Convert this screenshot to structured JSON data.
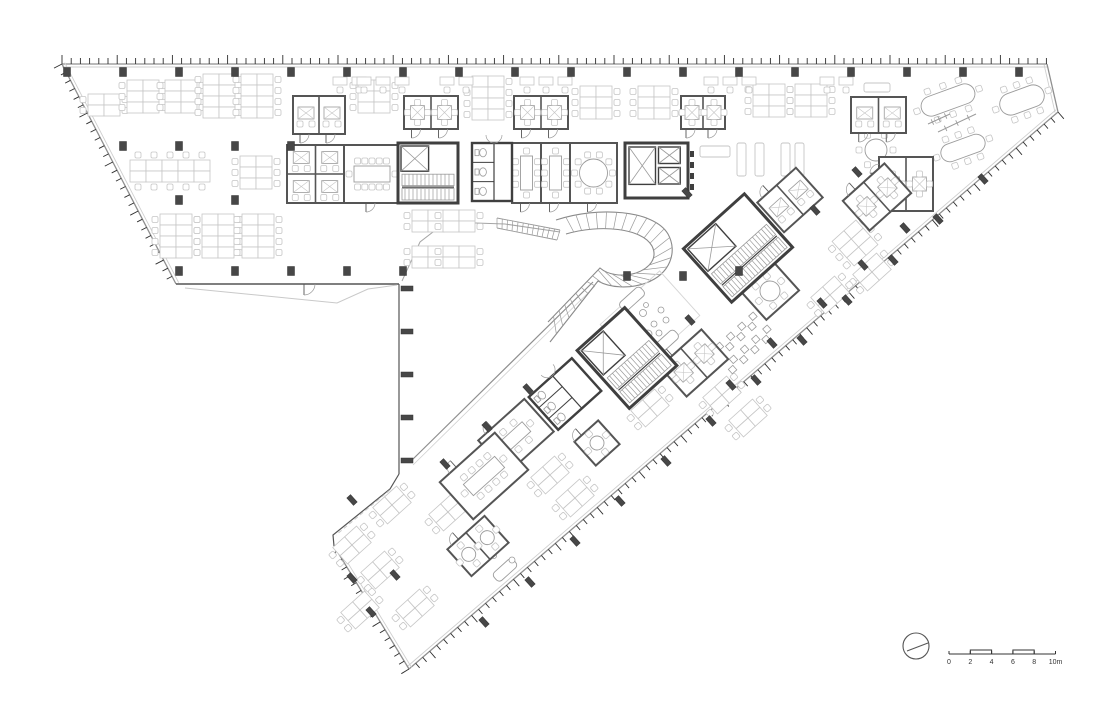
{
  "canvas": {
    "w": 1100,
    "h": 702,
    "bg": "#ffffff"
  },
  "colors": {
    "facade": "#8f8f8f",
    "facadeInner": "#cfcfcf",
    "tick": "#2e2e2e",
    "wall": "#555555",
    "wallDark": "#3f3f3f",
    "furn": "#c6c6c6",
    "furnMid": "#9b9b9b",
    "column": "#474747",
    "canopy": "#c9c9c9",
    "tread": "#9a9a9a",
    "curve": "#a5a5a5",
    "text": "#333333"
  },
  "facades": [
    {
      "x1": 62,
      "y1": 64,
      "x2": 1047,
      "y2": 64,
      "ticks": true,
      "side": -1
    },
    {
      "x1": 62,
      "y1": 64,
      "x2": 176,
      "y2": 284,
      "ticks": true,
      "side": 1
    },
    {
      "x1": 1047,
      "y1": 64,
      "x2": 1058,
      "y2": 112,
      "ticks": false,
      "side": -1
    },
    {
      "x1": 1058,
      "y1": 112,
      "x2": 409,
      "y2": 669,
      "ticks": true,
      "side": -1
    },
    {
      "x1": 409,
      "y1": 669,
      "x2": 334,
      "y2": 546,
      "ticks": true,
      "side": -1
    }
  ],
  "edges": [
    {
      "pts": [
        [
          334,
          546
        ],
        [
          333,
          535
        ],
        [
          390,
          489
        ],
        [
          399,
          474
        ]
      ],
      "w": 1.2,
      "c": "wall"
    },
    {
      "pts": [
        [
          399,
          474
        ],
        [
          399,
          284
        ]
      ],
      "w": 1.2,
      "c": "wall"
    },
    {
      "pts": [
        [
          399,
          284
        ],
        [
          176,
          284
        ]
      ],
      "w": 1.6,
      "c": "wall"
    },
    {
      "pts": [
        [
          185,
          288
        ],
        [
          337,
          303
        ],
        [
          368,
          289
        ],
        [
          397,
          285
        ]
      ],
      "w": 1,
      "c": "canopy"
    },
    {
      "pts": [
        [
          402,
          281
        ],
        [
          420,
          242
        ],
        [
          446,
          222
        ],
        [
          505,
          224
        ],
        [
          560,
          232
        ]
      ],
      "w": 1,
      "c": "curve"
    },
    {
      "pts": [
        [
          593,
          282
        ],
        [
          410,
          462
        ]
      ],
      "w": 1.2,
      "c": "facade"
    },
    {
      "pts": [
        [
          595,
          286
        ],
        [
          413,
          465
        ]
      ],
      "w": 0.8,
      "c": "facadeInner"
    },
    {
      "pts": [
        [
          390,
          490
        ],
        [
          336,
          535
        ]
      ],
      "w": 1,
      "c": "canopy",
      "dash": "4 3"
    }
  ],
  "entranceDoor": {
    "hx": 304,
    "hy": 284,
    "r": 11
  },
  "piers": {
    "vertical": [
      [
        401,
        286
      ],
      [
        401,
        329
      ],
      [
        401,
        372
      ],
      [
        401,
        415
      ],
      [
        401,
        458
      ]
    ],
    "rotated": [
      [
        687,
        193
      ],
      [
        815,
        210
      ],
      [
        857,
        172
      ],
      [
        905,
        228
      ],
      [
        863,
        265
      ],
      [
        822,
        303
      ],
      [
        690,
        320
      ],
      [
        772,
        343
      ],
      [
        731,
        385
      ],
      [
        528,
        389
      ],
      [
        487,
        427
      ],
      [
        445,
        464
      ],
      [
        352,
        500
      ],
      [
        395,
        575
      ]
    ],
    "facade": [
      [
        983,
        179
      ],
      [
        938,
        219
      ],
      [
        893,
        260
      ],
      [
        847,
        300
      ],
      [
        802,
        340
      ],
      [
        756,
        380
      ],
      [
        711,
        421
      ],
      [
        666,
        461
      ],
      [
        620,
        501
      ],
      [
        575,
        541
      ],
      [
        530,
        582
      ],
      [
        484,
        622
      ],
      [
        371,
        612
      ],
      [
        352,
        578
      ]
    ]
  },
  "columns": [
    [
      67,
      72
    ],
    [
      123,
      72
    ],
    [
      179,
      72
    ],
    [
      235,
      72
    ],
    [
      291,
      72
    ],
    [
      347,
      72
    ],
    [
      403,
      72
    ],
    [
      459,
      72
    ],
    [
      515,
      72
    ],
    [
      571,
      72
    ],
    [
      627,
      72
    ],
    [
      683,
      72
    ],
    [
      739,
      72
    ],
    [
      795,
      72
    ],
    [
      851,
      72
    ],
    [
      907,
      72
    ],
    [
      963,
      72
    ],
    [
      1019,
      72
    ],
    [
      123,
      146
    ],
    [
      179,
      146
    ],
    [
      235,
      146
    ],
    [
      291,
      146
    ],
    [
      179,
      200
    ],
    [
      235,
      200
    ],
    [
      179,
      271
    ],
    [
      235,
      271
    ],
    [
      291,
      271
    ],
    [
      347,
      271
    ],
    [
      403,
      271
    ],
    [
      627,
      276
    ],
    [
      683,
      276
    ],
    [
      739,
      271
    ]
  ],
  "clusters": {
    "axis": [
      [
        88,
        94,
        2,
        2
      ],
      [
        127,
        80,
        2,
        3
      ],
      [
        165,
        80,
        2,
        3
      ],
      [
        203,
        74,
        2,
        4
      ],
      [
        241,
        74,
        2,
        4
      ],
      [
        240,
        156,
        2,
        3
      ],
      [
        160,
        214,
        2,
        4
      ],
      [
        202,
        214,
        2,
        4
      ],
      [
        242,
        214,
        2,
        4
      ],
      [
        358,
        80,
        2,
        3
      ],
      [
        472,
        76,
        2,
        4
      ],
      [
        580,
        86,
        2,
        3
      ],
      [
        638,
        86,
        2,
        3
      ],
      [
        412,
        210,
        2,
        2
      ],
      [
        443,
        210,
        2,
        2
      ],
      [
        412,
        246,
        2,
        2
      ],
      [
        443,
        246,
        2,
        2
      ],
      [
        753,
        84,
        2,
        3
      ],
      [
        795,
        84,
        2,
        3
      ]
    ],
    "bench": [
      [
        130,
        160,
        5,
        2
      ]
    ],
    "rot": [
      [
        855,
        243,
        2,
        3
      ],
      [
        872,
        272,
        2,
        2
      ],
      [
        830,
        295,
        2,
        2
      ],
      [
        722,
        395,
        2,
        2
      ],
      [
        748,
        418,
        2,
        2
      ],
      [
        650,
        408,
        2,
        2
      ],
      [
        550,
        475,
        2,
        2
      ],
      [
        575,
        498,
        2,
        2
      ],
      [
        392,
        505,
        2,
        2
      ],
      [
        352,
        545,
        2,
        2
      ],
      [
        380,
        570,
        2,
        2
      ],
      [
        360,
        610,
        2,
        2
      ],
      [
        415,
        608,
        2,
        2
      ],
      [
        448,
        512,
        2,
        2
      ]
    ],
    "singles": [
      [
        333,
        2
      ],
      [
        357,
        3
      ],
      [
        440,
        2
      ],
      [
        520,
        3
      ],
      [
        704,
        3
      ],
      [
        820,
        2
      ]
    ],
    "singlesY": 77
  },
  "rooms": {
    "axis": [
      [
        293,
        96,
        52,
        38,
        2,
        "officeX",
        "b"
      ],
      [
        404,
        96,
        54,
        33,
        2,
        "table4",
        "b"
      ],
      [
        514,
        96,
        54,
        33,
        2,
        "table4",
        "b"
      ],
      [
        681,
        96,
        44,
        33,
        2,
        "table4",
        "b"
      ],
      [
        851,
        97,
        55,
        36,
        2,
        "officeX",
        "b"
      ],
      [
        287,
        145,
        57,
        58,
        4,
        "officeX",
        "n"
      ],
      [
        344,
        145,
        56,
        58,
        1,
        "conf12",
        "b"
      ],
      [
        512,
        143,
        29,
        60,
        1,
        "conf8v",
        "b"
      ],
      [
        541,
        143,
        29,
        60,
        1,
        "conf8v",
        "b"
      ],
      [
        570,
        143,
        47,
        60,
        1,
        "round10",
        "b"
      ],
      [
        879,
        157,
        54,
        54,
        2,
        "table4",
        "l"
      ]
    ],
    "rot": [
      [
        790,
        200,
        52,
        40,
        2,
        "officeX"
      ],
      [
        877,
        197,
        56,
        40,
        2,
        "table4"
      ],
      [
        770,
        291,
        44,
        38,
        1,
        "round6"
      ],
      [
        694,
        363,
        56,
        40,
        2,
        "table4"
      ],
      [
        597,
        443,
        32,
        32,
        1,
        "round4"
      ],
      [
        516,
        436,
        62,
        44,
        1,
        "conf6"
      ],
      [
        484,
        476,
        74,
        50,
        1,
        "conf10"
      ],
      [
        478,
        546,
        50,
        36,
        2,
        "round4"
      ]
    ]
  },
  "cores": {
    "axis": [
      [
        398,
        143,
        60,
        60,
        "stairlift"
      ],
      [
        472,
        143,
        40,
        58,
        "wc"
      ],
      [
        625,
        143,
        63,
        55,
        "lift2"
      ]
    ],
    "rot": [
      [
        738,
        248,
        82,
        72,
        "stairlift"
      ],
      [
        627,
        358,
        64,
        78,
        "stairlift"
      ],
      [
        565,
        394,
        58,
        44,
        "wc"
      ]
    ]
  },
  "stair": {
    "outer": "M 556,220 C 598,206 654,210 668,234 C 678,252 670,274 646,283 C 630,289 610,288 598,281 L 550,342",
    "inner": "M 566,234 C 600,224 642,228 652,246 C 658,258 650,268 636,273 C 622,277 608,275 600,268 L 548,322",
    "treads": 30,
    "flight": {
      "outer": "M 497,218 L 560,230",
      "inner": "M 497,228 L 557,240",
      "treads": 12
    }
  },
  "lounge": {
    "benches": [
      [
        700,
        146,
        30,
        11
      ],
      [
        737,
        143,
        9,
        33
      ],
      [
        755,
        143,
        9,
        33
      ],
      [
        781,
        143,
        9,
        33
      ],
      [
        795,
        143,
        9,
        33
      ],
      [
        864,
        83,
        26,
        9
      ]
    ],
    "hex": {
      "cx": 876,
      "cy": 150,
      "r": 11,
      "chairs": 6
    },
    "ovals": [
      [
        948,
        100,
        56,
        20,
        -20
      ],
      [
        1022,
        100,
        46,
        22,
        -20
      ],
      [
        963,
        148,
        46,
        18,
        -20
      ]
    ],
    "rails": [
      [
        938,
        132,
        976,
        114
      ],
      [
        928,
        124,
        950,
        114
      ]
    ],
    "platform": [
      650,
      320,
      80,
      60,
      -42
    ],
    "sofas": [
      [
        632,
        299,
        28,
        11,
        -42
      ],
      [
        666,
        342,
        28,
        11,
        -42
      ],
      [
        505,
        570,
        26,
        11,
        -42
      ]
    ],
    "blobs": [
      [
        643,
        313,
        3.5
      ],
      [
        654,
        324,
        3
      ],
      [
        661,
        310,
        3
      ],
      [
        648,
        334,
        4
      ],
      [
        637,
        324,
        2.5
      ],
      [
        659,
        333,
        3
      ],
      [
        646,
        305,
        2.5
      ],
      [
        666,
        320,
        3
      ],
      [
        512,
        560,
        3
      ],
      [
        494,
        556,
        2.5
      ]
    ],
    "zigzag": {
      "starts": [
        [
          714,
          356
        ],
        [
          728,
          369
        ]
      ],
      "n": 8,
      "rot": -42
    }
  },
  "north": {
    "cx": 916,
    "cy": 646,
    "r": 13,
    "needle": [
      907,
      651,
      928,
      643
    ]
  },
  "scalebar": {
    "x": 949,
    "y": 654,
    "unit": 10.65,
    "labels": [
      "0",
      "2",
      "4",
      "6",
      "8",
      "10m"
    ],
    "raised": [
      [
        2,
        4
      ],
      [
        6,
        8
      ]
    ]
  }
}
